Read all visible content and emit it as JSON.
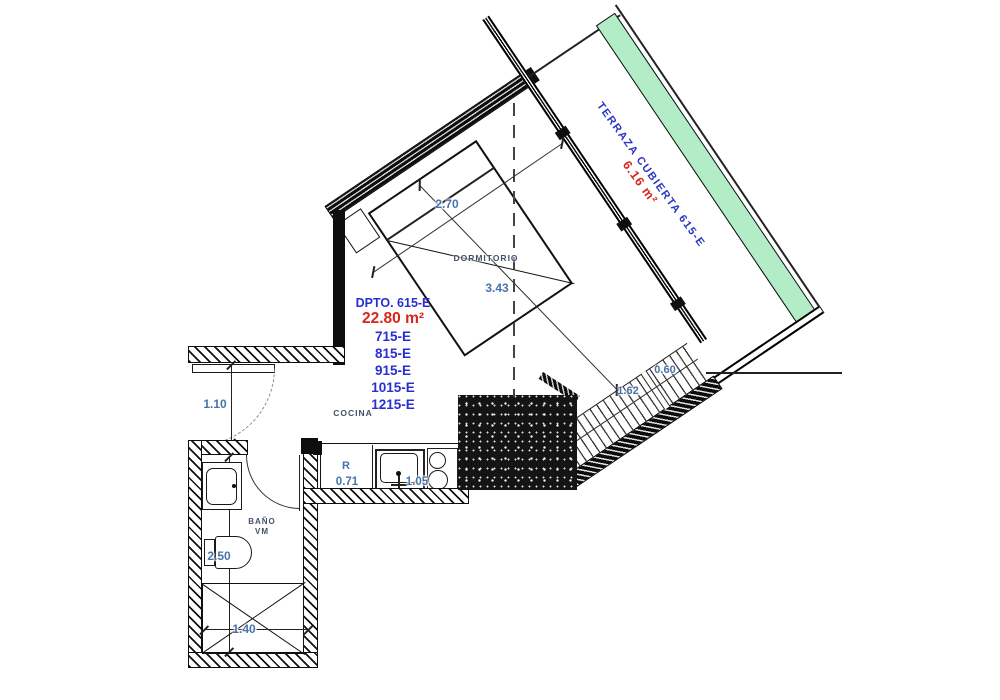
{
  "unit_info": {
    "title": "DPTO. 615-E",
    "area": "22.80 m²",
    "stacked_units": [
      "715-E",
      "815-E",
      "915-E",
      "1015-E",
      "1215-E"
    ]
  },
  "rooms": {
    "bedroom": "DORMITORIO",
    "kitchen": "COCINA",
    "bathroom": "BAÑO",
    "bathroom_sub": "VM",
    "terrace": "TERRAZA CUBIERTA 615-E",
    "terrace_area": "6.16 m²"
  },
  "fixtures": {
    "refrigerator": "R"
  },
  "dimensions": {
    "bedroom_width": "2.70",
    "bedroom_diagonal": "3.43",
    "hall_width": "1.10",
    "bathroom_length": "2.50",
    "shower_width": "1.40",
    "refrigerator_width": "0.71",
    "counter_width": "1.05",
    "closet_length": "1.62",
    "closet_depth": "0.60"
  },
  "colors": {
    "terrace_green": "#b3edc7",
    "unit_blue": "#282ed2",
    "area_red": "#d6271c",
    "dimension_blue": "#4a72ab",
    "room_label_navy": "#44506a",
    "wall_black": "#0e0e0e"
  }
}
